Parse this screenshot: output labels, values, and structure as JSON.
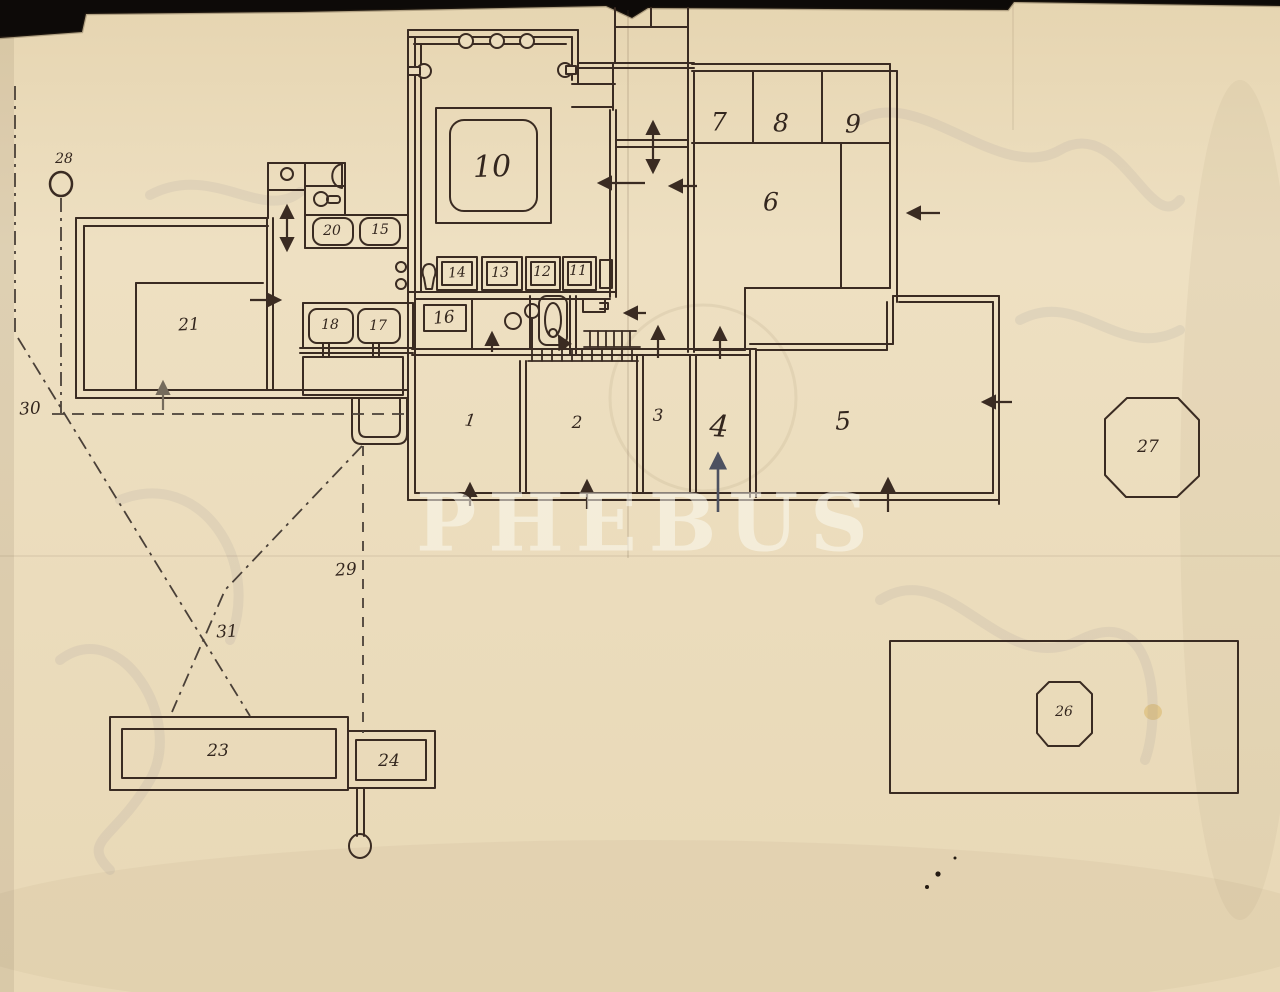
{
  "watermark": "PHEBUS",
  "labels": {
    "r1": "1",
    "r2": "2",
    "r3": "3",
    "r4": "4",
    "r5": "5",
    "r6": "6",
    "r7": "7",
    "r8": "8",
    "r9": "9",
    "r10": "10",
    "r11": "11",
    "r12": "12",
    "r13": "13",
    "r14": "14",
    "r15": "15",
    "r16": "16",
    "r17": "17",
    "r18": "18",
    "r20": "20",
    "r21": "21",
    "r23": "23",
    "r24": "24",
    "r26": "26",
    "r27": "27",
    "r28": "28",
    "r29": "29",
    "r30": "30",
    "r31": "31"
  },
  "colors": {
    "paper": "#ebdcbc",
    "ink": "#3a2b22",
    "scan_background": "#0d0a08",
    "watermark_text": "#fcfaf0",
    "blue_ink_arrow": "#4d5160"
  }
}
